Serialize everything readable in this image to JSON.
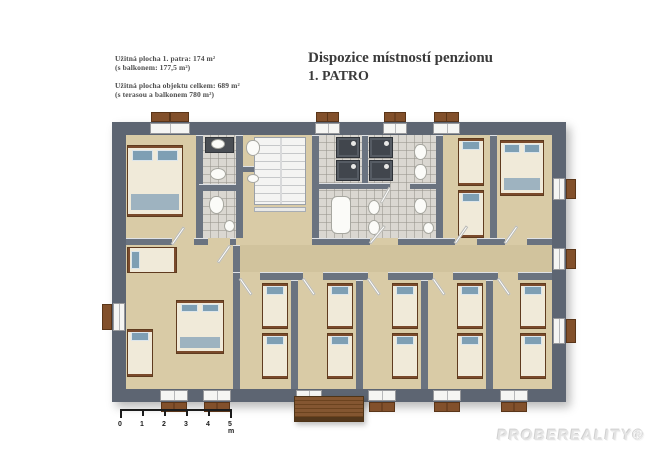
{
  "header": {
    "title_line1": "Dispozice místností penzionu",
    "title_line2": "1. PATRO",
    "area_info": {
      "line1": "Užitná plocha 1. patra: 174 m²",
      "line2": "(s balkonem: 177,5 m²)",
      "line3": "Užitná plocha objektu celkem: 689 m²",
      "line4": "(s terasou a balkonem 780 m²)"
    }
  },
  "scale_bar": {
    "labels": [
      "0",
      "1",
      "2",
      "3",
      "4",
      "5 m"
    ],
    "tick_spacing_px": 22
  },
  "watermark": "PROBEREALITY®",
  "floor_plan": {
    "colors": {
      "wall": "#5d6572",
      "interior_wall": "#6a7380",
      "floor": "#d9cba6",
      "corridor": "#d1c39d",
      "tile": "#dad7d1",
      "bed_frame": "#7a4a2b",
      "bed_linen": "#f0ead9",
      "pillow_blue": "#7e9fb4",
      "shutter_wood": "#82502b",
      "balcony_wood": "#7b4d28",
      "shower_dark": "#41464d"
    },
    "base": {
      "x": 112,
      "y": 122,
      "w": 454,
      "h": 280
    },
    "floors": [
      {
        "name": "interior-floor",
        "cls": "floor",
        "x": 126,
        "y": 135,
        "w": 426,
        "h": 254
      },
      {
        "name": "corridor-floor",
        "cls": "floor-corridor",
        "x": 240,
        "y": 245,
        "w": 312,
        "h": 27
      },
      {
        "name": "ensuite-bath-floor",
        "cls": "floor-tile",
        "x": 203,
        "y": 135,
        "w": 33,
        "h": 103
      },
      {
        "name": "shared-bath-floor",
        "cls": "floor-tile",
        "x": 319,
        "y": 135,
        "w": 117,
        "h": 103
      }
    ],
    "walls": [
      {
        "x": 196,
        "y": 135,
        "w": 7,
        "h": 103
      },
      {
        "x": 236,
        "y": 135,
        "w": 7,
        "h": 103
      },
      {
        "x": 312,
        "y": 135,
        "w": 7,
        "h": 103
      },
      {
        "x": 436,
        "y": 135,
        "w": 7,
        "h": 103
      },
      {
        "x": 490,
        "y": 135,
        "w": 7,
        "h": 103
      },
      {
        "x": 362,
        "y": 135,
        "w": 6,
        "h": 48
      },
      {
        "x": 233,
        "y": 245,
        "w": 7,
        "h": 144
      },
      {
        "x": 291,
        "y": 280,
        "w": 7,
        "h": 109
      },
      {
        "x": 356,
        "y": 280,
        "w": 7,
        "h": 109
      },
      {
        "x": 421,
        "y": 280,
        "w": 7,
        "h": 109
      },
      {
        "x": 486,
        "y": 280,
        "w": 7,
        "h": 109
      },
      {
        "x": 126,
        "y": 238,
        "w": 46,
        "h": 7
      },
      {
        "x": 194,
        "y": 238,
        "w": 14,
        "h": 7
      },
      {
        "x": 230,
        "y": 238,
        "w": 6,
        "h": 7
      },
      {
        "x": 312,
        "y": 238,
        "w": 58,
        "h": 7
      },
      {
        "x": 398,
        "y": 238,
        "w": 57,
        "h": 7
      },
      {
        "x": 477,
        "y": 238,
        "w": 28,
        "h": 7
      },
      {
        "x": 527,
        "y": 238,
        "w": 25,
        "h": 7
      },
      {
        "x": 233,
        "y": 272,
        "w": 7,
        "h": 8
      },
      {
        "x": 260,
        "y": 272,
        "w": 43,
        "h": 8
      },
      {
        "x": 323,
        "y": 272,
        "w": 45,
        "h": 8
      },
      {
        "x": 388,
        "y": 272,
        "w": 45,
        "h": 8
      },
      {
        "x": 453,
        "y": 272,
        "w": 45,
        "h": 8
      },
      {
        "x": 518,
        "y": 272,
        "w": 34,
        "h": 8
      },
      {
        "x": 199,
        "y": 184,
        "w": 37,
        "h": 7
      },
      {
        "x": 319,
        "y": 183,
        "w": 71,
        "h": 6
      },
      {
        "x": 410,
        "y": 183,
        "w": 26,
        "h": 6
      },
      {
        "x": 243,
        "y": 166,
        "w": 24,
        "h": 6
      }
    ],
    "outer_walls": [
      {
        "x": 112,
        "y": 122,
        "w": 454,
        "h": 13
      },
      {
        "x": 112,
        "y": 389,
        "w": 454,
        "h": 13
      },
      {
        "x": 112,
        "y": 122,
        "w": 14,
        "h": 280
      },
      {
        "x": 552,
        "y": 122,
        "w": 14,
        "h": 280
      }
    ],
    "windows": [
      {
        "x": 150,
        "y": 123,
        "w": 40,
        "h": 11
      },
      {
        "x": 315,
        "y": 123,
        "w": 25,
        "h": 11
      },
      {
        "x": 383,
        "y": 123,
        "w": 24,
        "h": 11
      },
      {
        "x": 433,
        "y": 123,
        "w": 27,
        "h": 11
      },
      {
        "x": 160,
        "y": 390,
        "w": 28,
        "h": 11
      },
      {
        "x": 203,
        "y": 390,
        "w": 28,
        "h": 11
      },
      {
        "x": 296,
        "y": 390,
        "w": 26,
        "h": 11
      },
      {
        "x": 368,
        "y": 390,
        "w": 28,
        "h": 11
      },
      {
        "x": 433,
        "y": 390,
        "w": 28,
        "h": 11
      },
      {
        "x": 500,
        "y": 390,
        "w": 28,
        "h": 11
      },
      {
        "x": 113,
        "y": 303,
        "w": 12,
        "h": 28
      },
      {
        "x": 553,
        "y": 178,
        "w": 12,
        "h": 22
      },
      {
        "x": 553,
        "y": 248,
        "w": 12,
        "h": 22
      },
      {
        "x": 553,
        "y": 318,
        "w": 12,
        "h": 26
      }
    ],
    "shutters": [
      {
        "x": 151,
        "y": 112,
        "w": 38,
        "h": 10
      },
      {
        "x": 316,
        "y": 112,
        "w": 23,
        "h": 10
      },
      {
        "x": 384,
        "y": 112,
        "w": 22,
        "h": 10
      },
      {
        "x": 434,
        "y": 112,
        "w": 25,
        "h": 10
      },
      {
        "x": 161,
        "y": 402,
        "w": 26,
        "h": 10
      },
      {
        "x": 204,
        "y": 402,
        "w": 26,
        "h": 10
      },
      {
        "x": 369,
        "y": 402,
        "w": 26,
        "h": 10
      },
      {
        "x": 434,
        "y": 402,
        "w": 26,
        "h": 10
      },
      {
        "x": 501,
        "y": 402,
        "w": 26,
        "h": 10
      },
      {
        "x": 102,
        "y": 304,
        "w": 10,
        "h": 26
      },
      {
        "x": 566,
        "y": 179,
        "w": 10,
        "h": 20
      },
      {
        "x": 566,
        "y": 249,
        "w": 10,
        "h": 20
      },
      {
        "x": 566,
        "y": 319,
        "w": 10,
        "h": 24
      }
    ],
    "stairs": {
      "x": 254,
      "y": 137,
      "w": 52,
      "h": 68
    },
    "stair_rail": {
      "x": 254,
      "y": 207,
      "w": 52,
      "h": 5
    },
    "fixtures": [
      {
        "type": "counter",
        "x": 205,
        "y": 137,
        "w": 29,
        "h": 16
      },
      {
        "type": "sink",
        "x": 211,
        "y": 139,
        "w": 14,
        "h": 10
      },
      {
        "type": "sink",
        "x": 210,
        "y": 168,
        "w": 16,
        "h": 12
      },
      {
        "type": "toilet",
        "x": 209,
        "y": 196,
        "w": 15,
        "h": 18
      },
      {
        "type": "sink",
        "x": 224,
        "y": 220,
        "w": 11,
        "h": 12
      },
      {
        "type": "toilet",
        "x": 246,
        "y": 140,
        "w": 14,
        "h": 16
      },
      {
        "type": "sink",
        "x": 247,
        "y": 174,
        "w": 12,
        "h": 9
      },
      {
        "type": "shower",
        "x": 336,
        "y": 137,
        "w": 24,
        "h": 21
      },
      {
        "type": "shower",
        "x": 369,
        "y": 137,
        "w": 24,
        "h": 21
      },
      {
        "type": "shower",
        "x": 336,
        "y": 160,
        "w": 24,
        "h": 21
      },
      {
        "type": "shower",
        "x": 369,
        "y": 160,
        "w": 24,
        "h": 21
      },
      {
        "type": "toilet",
        "x": 414,
        "y": 144,
        "w": 13,
        "h": 16
      },
      {
        "type": "toilet",
        "x": 414,
        "y": 164,
        "w": 13,
        "h": 16
      },
      {
        "type": "tub",
        "x": 331,
        "y": 196,
        "w": 20,
        "h": 38
      },
      {
        "type": "sink",
        "x": 368,
        "y": 200,
        "w": 12,
        "h": 15
      },
      {
        "type": "sink",
        "x": 368,
        "y": 220,
        "w": 12,
        "h": 15
      },
      {
        "type": "toilet",
        "x": 414,
        "y": 198,
        "w": 13,
        "h": 16
      },
      {
        "type": "sink",
        "x": 423,
        "y": 222,
        "w": 11,
        "h": 12
      }
    ],
    "beds": [
      {
        "type": "double",
        "x": 127,
        "y": 145,
        "w": 56,
        "h": 72
      },
      {
        "type": "double",
        "x": 500,
        "y": 140,
        "w": 44,
        "h": 56
      },
      {
        "type": "double",
        "x": 176,
        "y": 300,
        "w": 48,
        "h": 54
      },
      {
        "type": "single",
        "x": 458,
        "y": 138,
        "w": 26,
        "h": 48
      },
      {
        "type": "single",
        "x": 458,
        "y": 190,
        "w": 26,
        "h": 48
      },
      {
        "type": "single-h",
        "x": 127,
        "y": 247,
        "w": 50,
        "h": 26
      },
      {
        "type": "single",
        "x": 127,
        "y": 329,
        "w": 26,
        "h": 48
      },
      {
        "type": "single",
        "x": 262,
        "y": 283,
        "w": 26,
        "h": 46
      },
      {
        "type": "single",
        "x": 262,
        "y": 333,
        "w": 26,
        "h": 46
      },
      {
        "type": "single",
        "x": 327,
        "y": 283,
        "w": 26,
        "h": 46
      },
      {
        "type": "single",
        "x": 327,
        "y": 333,
        "w": 26,
        "h": 46
      },
      {
        "type": "single",
        "x": 392,
        "y": 283,
        "w": 26,
        "h": 46
      },
      {
        "type": "single",
        "x": 392,
        "y": 333,
        "w": 26,
        "h": 46
      },
      {
        "type": "single",
        "x": 457,
        "y": 283,
        "w": 26,
        "h": 46
      },
      {
        "type": "single",
        "x": 457,
        "y": 333,
        "w": 26,
        "h": 46
      },
      {
        "type": "single",
        "x": 520,
        "y": 283,
        "w": 26,
        "h": 46
      },
      {
        "type": "single",
        "x": 520,
        "y": 333,
        "w": 26,
        "h": 46
      }
    ],
    "doors": [
      {
        "x": 172,
        "y": 243,
        "len": 21,
        "rot": -55
      },
      {
        "x": 230,
        "y": 244,
        "len": 21,
        "rot": 125
      },
      {
        "x": 370,
        "y": 242,
        "len": 23,
        "rot": -50
      },
      {
        "x": 455,
        "y": 242,
        "len": 21,
        "rot": -55
      },
      {
        "x": 505,
        "y": 242,
        "len": 21,
        "rot": -55
      },
      {
        "x": 390,
        "y": 186,
        "len": 18,
        "rot": 120
      },
      {
        "x": 240,
        "y": 277,
        "len": 20,
        "rot": 55
      },
      {
        "x": 303,
        "y": 277,
        "len": 20,
        "rot": 55
      },
      {
        "x": 368,
        "y": 277,
        "len": 20,
        "rot": 55
      },
      {
        "x": 433,
        "y": 277,
        "len": 20,
        "rot": 55
      },
      {
        "x": 498,
        "y": 277,
        "len": 20,
        "rot": 55
      }
    ],
    "balcony": {
      "x": 294,
      "y": 396,
      "w": 70,
      "h": 26
    }
  }
}
